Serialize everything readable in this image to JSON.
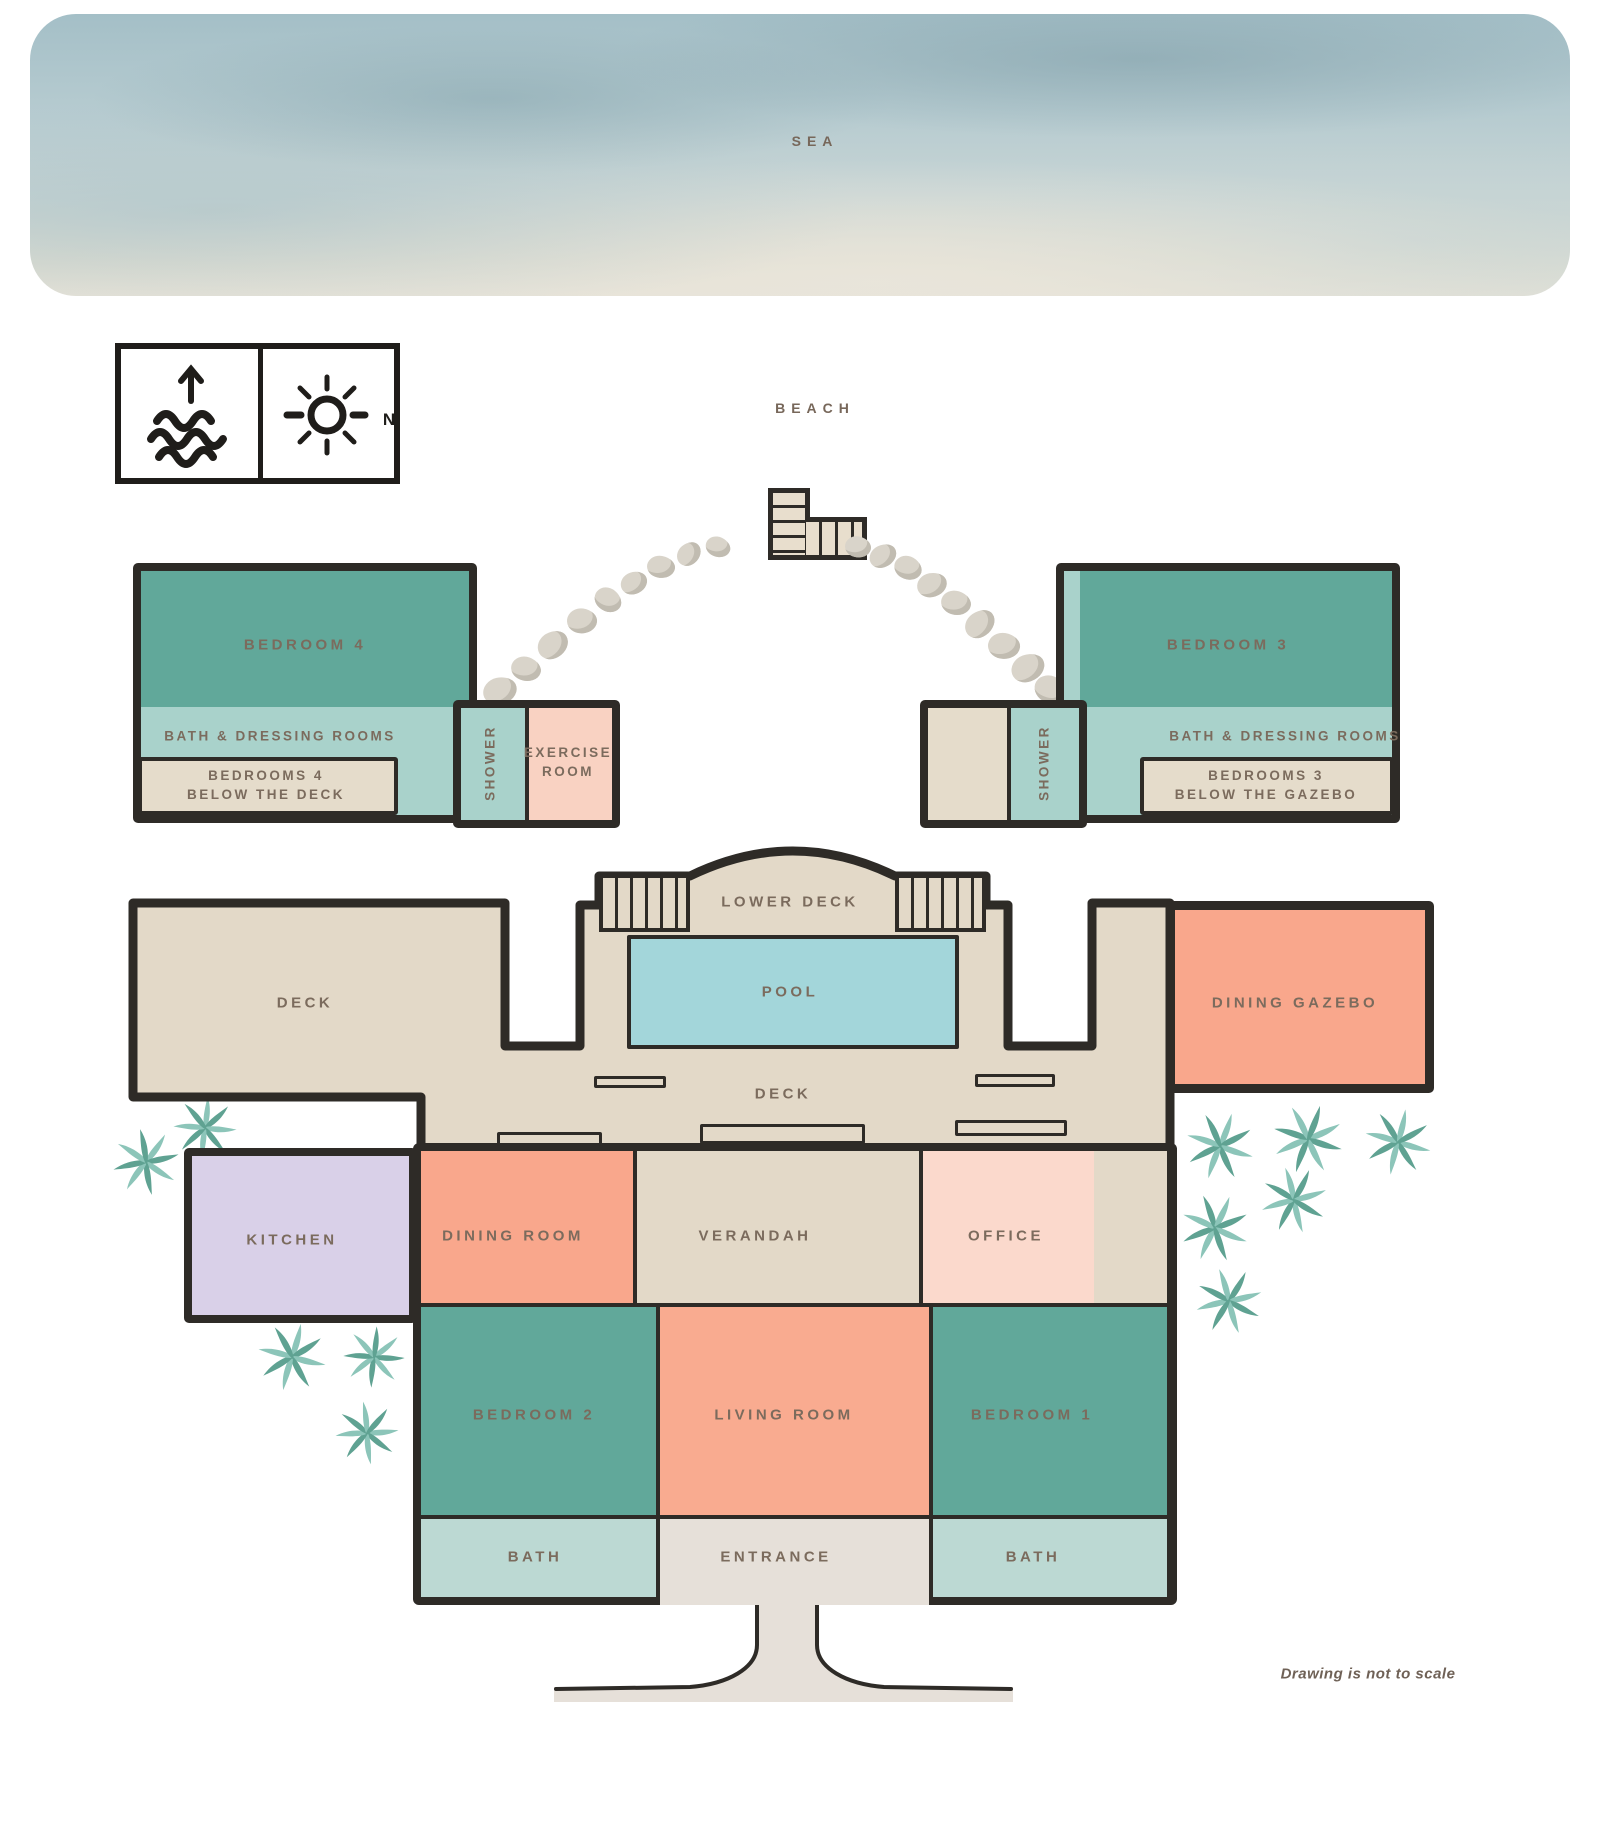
{
  "environment": {
    "sea": "SEA",
    "beach": "BEACH"
  },
  "compass": {
    "north": "N"
  },
  "labels": {
    "bedroom4": "BEDROOM 4",
    "bath_dressing_left": "BATH & DRESSING ROOMS",
    "below_deck_line1": "BEDROOMS 4",
    "below_deck_line2": "BELOW THE DECK",
    "shower_left": "SHOWER",
    "exercise_line1": "EXERCISE",
    "exercise_line2": "ROOM",
    "bedroom3": "BEDROOM 3",
    "bath_dressing_right": "BATH & DRESSING ROOMS",
    "below_gazebo_line1": "BEDROOMS 3",
    "below_gazebo_line2": "BELOW THE GAZEBO",
    "shower_right": "SHOWER",
    "lower_deck": "LOWER DECK",
    "deck_left": "DECK",
    "pool": "POOL",
    "deck_middle": "DECK",
    "dining_gazebo": "DINING GAZEBO",
    "kitchen": "KITCHEN",
    "dining_room": "DINING ROOM",
    "verandah": "VERANDAH",
    "office": "OFFICE",
    "bedroom2": "BEDROOM 2",
    "living_room": "LIVING ROOM",
    "bedroom1": "BEDROOM 1",
    "bath_left": "BATH",
    "entrance": "ENTRANCE",
    "bath_right": "BATH",
    "note": "Drawing is not to scale"
  },
  "palette": {
    "wall": "#2e2b27",
    "label_brown": "#7b6b5d",
    "bedroom_teal": "#61a89a",
    "bath_teal_light": "#a9d2cb",
    "bath_row_light": "#bcd9d3",
    "deck_beige": "#e3d9c8",
    "entrance_beige": "#e6e0d9",
    "salmon": "#f9a78c",
    "office_pink": "#fbd9cc",
    "exercise_pink": "#f9d2c2",
    "kitchen_lavender": "#d9d0e8",
    "pool_blue": "#a3d6da",
    "palm_light": "#8cc5b9",
    "palm_dark": "#5fa292",
    "stone_gray": "#d9d4ca",
    "sea_teal": "#a4bfc7"
  },
  "decor": {
    "stones": [
      {
        "x": 500,
        "y": 691,
        "w": 34,
        "h": 27,
        "r": -12
      },
      {
        "x": 526,
        "y": 669,
        "w": 30,
        "h": 24,
        "r": 20
      },
      {
        "x": 553,
        "y": 645,
        "w": 32,
        "h": 26,
        "r": -30
      },
      {
        "x": 582,
        "y": 621,
        "w": 30,
        "h": 25,
        "r": 8
      },
      {
        "x": 608,
        "y": 600,
        "w": 28,
        "h": 23,
        "r": 40
      },
      {
        "x": 634,
        "y": 583,
        "w": 27,
        "h": 22,
        "r": -18
      },
      {
        "x": 661,
        "y": 567,
        "w": 28,
        "h": 22,
        "r": 12
      },
      {
        "x": 689,
        "y": 554,
        "w": 26,
        "h": 21,
        "r": -40
      },
      {
        "x": 718,
        "y": 547,
        "w": 25,
        "h": 20,
        "r": 25
      },
      {
        "x": 858,
        "y": 547,
        "w": 26,
        "h": 21,
        "r": 15
      },
      {
        "x": 883,
        "y": 556,
        "w": 28,
        "h": 22,
        "r": -25
      },
      {
        "x": 908,
        "y": 568,
        "w": 28,
        "h": 23,
        "r": 30
      },
      {
        "x": 932,
        "y": 585,
        "w": 30,
        "h": 24,
        "r": -10
      },
      {
        "x": 956,
        "y": 603,
        "w": 30,
        "h": 24,
        "r": 18
      },
      {
        "x": 980,
        "y": 624,
        "w": 32,
        "h": 25,
        "r": -35
      },
      {
        "x": 1004,
        "y": 646,
        "w": 32,
        "h": 26,
        "r": 10
      },
      {
        "x": 1028,
        "y": 668,
        "w": 34,
        "h": 27,
        "r": -20
      },
      {
        "x": 1051,
        "y": 690,
        "w": 34,
        "h": 27,
        "r": 32
      }
    ],
    "palms": [
      {
        "x": 205,
        "y": 1128,
        "s": 70,
        "r": 0
      },
      {
        "x": 146,
        "y": 1162,
        "s": 74,
        "r": 30
      },
      {
        "x": 292,
        "y": 1357,
        "s": 76,
        "r": 10
      },
      {
        "x": 374,
        "y": 1357,
        "s": 68,
        "r": 45
      },
      {
        "x": 367,
        "y": 1433,
        "s": 70,
        "r": 80
      },
      {
        "x": 1220,
        "y": 1146,
        "s": 76,
        "r": 15
      },
      {
        "x": 1308,
        "y": 1139,
        "s": 78,
        "r": 60
      },
      {
        "x": 1398,
        "y": 1142,
        "s": 74,
        "r": 100
      },
      {
        "x": 1294,
        "y": 1200,
        "s": 74,
        "r": 160
      },
      {
        "x": 1215,
        "y": 1228,
        "s": 76,
        "r": 200
      },
      {
        "x": 1229,
        "y": 1301,
        "s": 74,
        "r": 250
      }
    ]
  }
}
